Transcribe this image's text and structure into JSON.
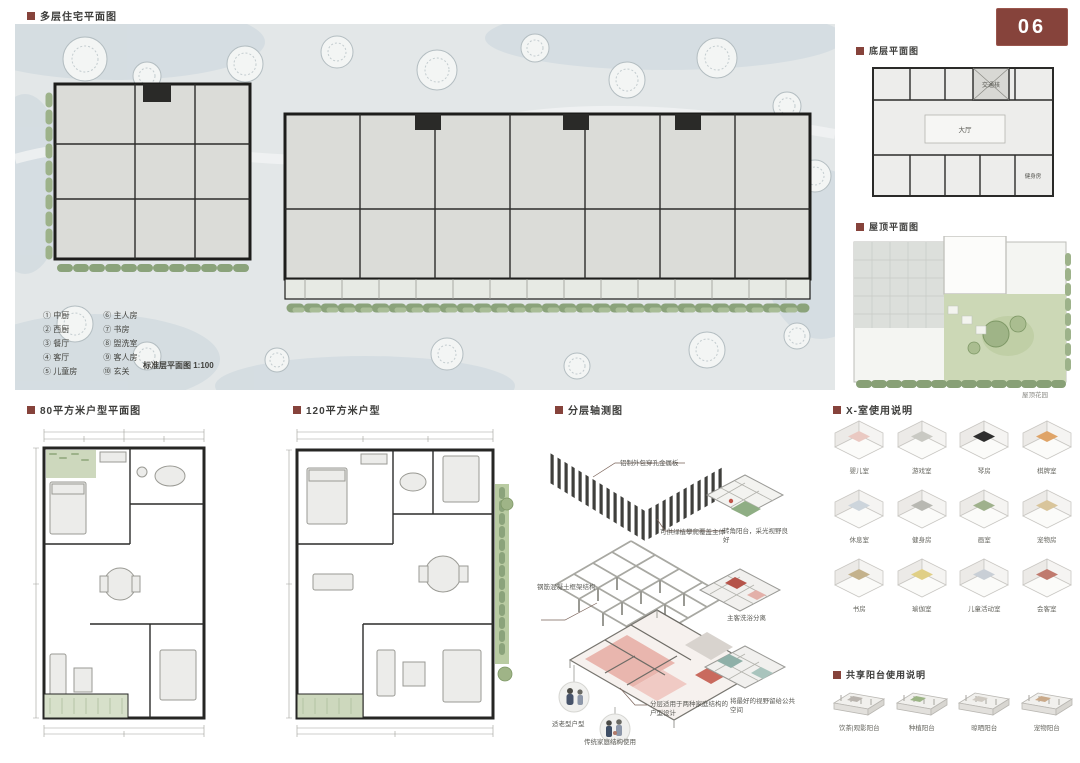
{
  "accent_color": "#86433b",
  "page_badge": "06",
  "titles": {
    "main": "多层住宅平面图",
    "ground": "底层平面图",
    "roof": "屋顶平面图",
    "unit80": "80平方米户型平面图",
    "unit120": "120平方米户型",
    "axon": "分层轴测图",
    "xrooms": "X-室使用说明",
    "balcony": "共享阳台使用说明"
  },
  "main_plan": {
    "caption": "标准层平面图 1:100",
    "legend_left": [
      {
        "num": "①",
        "label": "中厨"
      },
      {
        "num": "②",
        "label": "西厨"
      },
      {
        "num": "③",
        "label": "餐厅"
      },
      {
        "num": "④",
        "label": "客厅"
      },
      {
        "num": "⑤",
        "label": "儿童房"
      }
    ],
    "legend_right": [
      {
        "num": "⑥",
        "label": "主人房"
      },
      {
        "num": "⑦",
        "label": "书房"
      },
      {
        "num": "⑧",
        "label": "盥洗室"
      },
      {
        "num": "⑨",
        "label": "客人房"
      },
      {
        "num": "⑩",
        "label": "玄关"
      }
    ]
  },
  "ground_plan": {
    "core_label": "交通核",
    "hall_label": "大厅",
    "gym_label": "健身房"
  },
  "roof_plan": {
    "caption": "屋顶花园"
  },
  "axon": {
    "panel": "铝制外包穿孔金属板",
    "greenery": "可供绿植攀爬覆盖主体",
    "structure": "钢筋混凝土框架结构",
    "dual": "分层适用于两种家庭结构的户型设计",
    "vignette_elder": "适老型户型",
    "vignette_family": "传统家庭结构使用",
    "corner": "转角阳台，采光视野良好",
    "bath": "主客洗浴分离",
    "view": "将最好的视野留给公共空间"
  },
  "xrooms": {
    "items": [
      {
        "label": "婴儿室",
        "accent": "#eac9c2"
      },
      {
        "label": "游戏室",
        "accent": "#c9c9c3"
      },
      {
        "label": "琴房",
        "accent": "#2e2e2e"
      },
      {
        "label": "棋牌室",
        "accent": "#dfa468"
      },
      {
        "label": "休息室",
        "accent": "#cdd5dc"
      },
      {
        "label": "健身房",
        "accent": "#b8b8b2"
      },
      {
        "label": "画室",
        "accent": "#9fb18c"
      },
      {
        "label": "宠物房",
        "accent": "#d9c59b"
      },
      {
        "label": "书房",
        "accent": "#c4b28c"
      },
      {
        "label": "瑜伽室",
        "accent": "#e0cf86"
      },
      {
        "label": "儿童活动室",
        "accent": "#c9cfd6"
      },
      {
        "label": "会客室",
        "accent": "#c07a6e"
      }
    ]
  },
  "balconies": {
    "items": [
      {
        "label": "饮茶|观影阳台",
        "accent": "#b9b4ae"
      },
      {
        "label": "种植阳台",
        "accent": "#9cb585"
      },
      {
        "label": "晾晒阳台",
        "accent": "#cfcac2"
      },
      {
        "label": "宠物阳台",
        "accent": "#c9a989"
      }
    ]
  }
}
